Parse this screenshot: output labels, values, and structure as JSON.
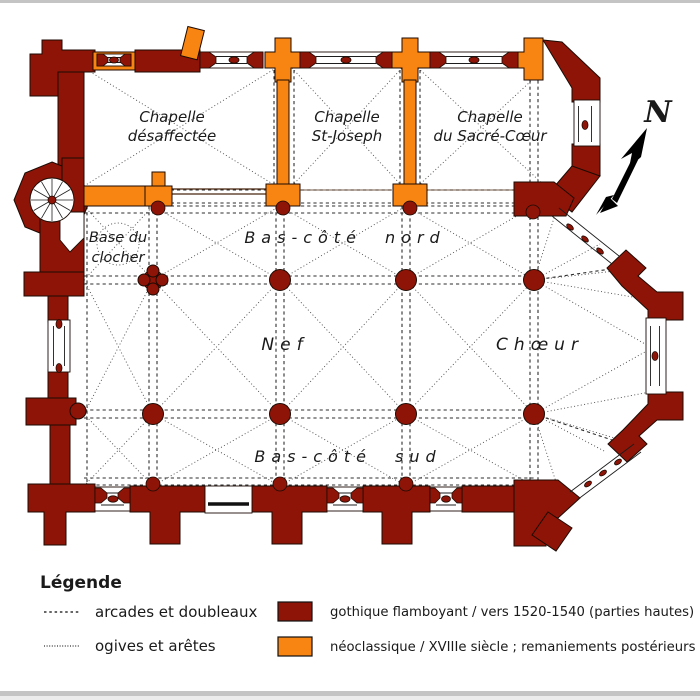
{
  "plan": {
    "labels": {
      "chapelle_desaffectee_1": "Chapelle",
      "chapelle_desaffectee_2": "désaffectée",
      "chapelle_st_joseph_1": "Chapelle",
      "chapelle_st_joseph_2": "St-Joseph",
      "chapelle_sacre_coeur_1": "Chapelle",
      "chapelle_sacre_coeur_2": "du Sacré-Cœur",
      "base_du_clocher_1": "Base du",
      "base_du_clocher_2": "clocher",
      "bas_cote_nord": "Bas-côté nord",
      "nef": "Nef",
      "choeur": "Chœur",
      "bas_cote_sud": "Bas-côté sud"
    },
    "compass": {
      "north_label": "N"
    }
  },
  "legend": {
    "title": "Légende",
    "line_items": [
      {
        "label": "arcades et doubleaux",
        "line_style": "dashed"
      },
      {
        "label": "ogives et arêtes",
        "line_style": "dotted"
      }
    ],
    "color_items": [
      {
        "label": "gothique flamboyant / vers 1520-1540 (parties hautes)",
        "color": "#8e1407"
      },
      {
        "label": "néoclassique / XVIIIe siècle ; remaniements postérieurs",
        "color": "#f88511"
      }
    ]
  },
  "colors": {
    "gothic": "#8e1407",
    "neoclassic": "#f88511",
    "outline": "#1c0b04"
  }
}
